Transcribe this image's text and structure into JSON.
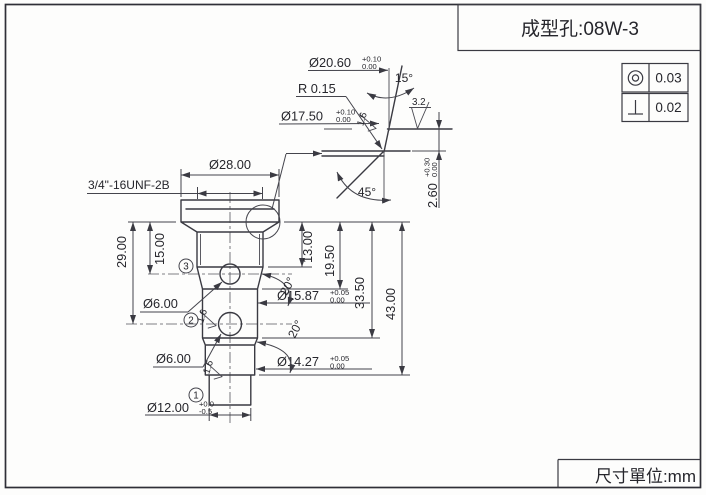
{
  "title_block": {
    "part_label": "成型孔:08W-3"
  },
  "gdt": {
    "concentricity_value": "0.03",
    "perpendicularity_value": "0.02"
  },
  "footer": {
    "unit_note": "尺寸單位:mm"
  },
  "main_view": {
    "flange_dia": "Ø28.00",
    "thread_spec": "3/4\"-16UNF-2B",
    "dim_15": "15.00",
    "dim_29": "29.00",
    "dim_13": "13.00",
    "dim_19_5": "19.50",
    "dim_33_5": "33.50",
    "dim_43": "43.00",
    "hole_top_dia": "Ø6.00",
    "hole_bottom_dia": "Ø6.00",
    "bore_upper": {
      "value": "Ø15.87",
      "tol_plus": "+0.05",
      "tol_minus": "0.00"
    },
    "bore_lower": {
      "value": "Ø14.27",
      "tol_plus": "+0.05",
      "tol_minus": "0.00"
    },
    "stem": {
      "value": "Ø12.00",
      "tol_plus": "+0.0",
      "tol_minus": "-0.5"
    },
    "chamfer_angle_upper": "20°",
    "chamfer_angle_lower": "20°",
    "balloon_1": "1",
    "balloon_2": "2",
    "balloon_3": "3",
    "finish_upper": "1.6",
    "finish_lower": "1.6"
  },
  "detail_view": {
    "mouth_dia": {
      "value": "Ø20.60",
      "tol_plus": "+0.10",
      "tol_minus": "0.00"
    },
    "bore_dia": {
      "value": "Ø17.50",
      "tol_plus": "+0.10",
      "tol_minus": "0.00"
    },
    "fillet_radius": "R 0.15",
    "taper_angle": "15°",
    "chamfer_angle": "45°",
    "depth": {
      "value": "2.60",
      "tol_plus": "+0.30",
      "tol_minus": "0.00"
    },
    "finish_face": "3.2",
    "finish_wall": "1.6"
  }
}
